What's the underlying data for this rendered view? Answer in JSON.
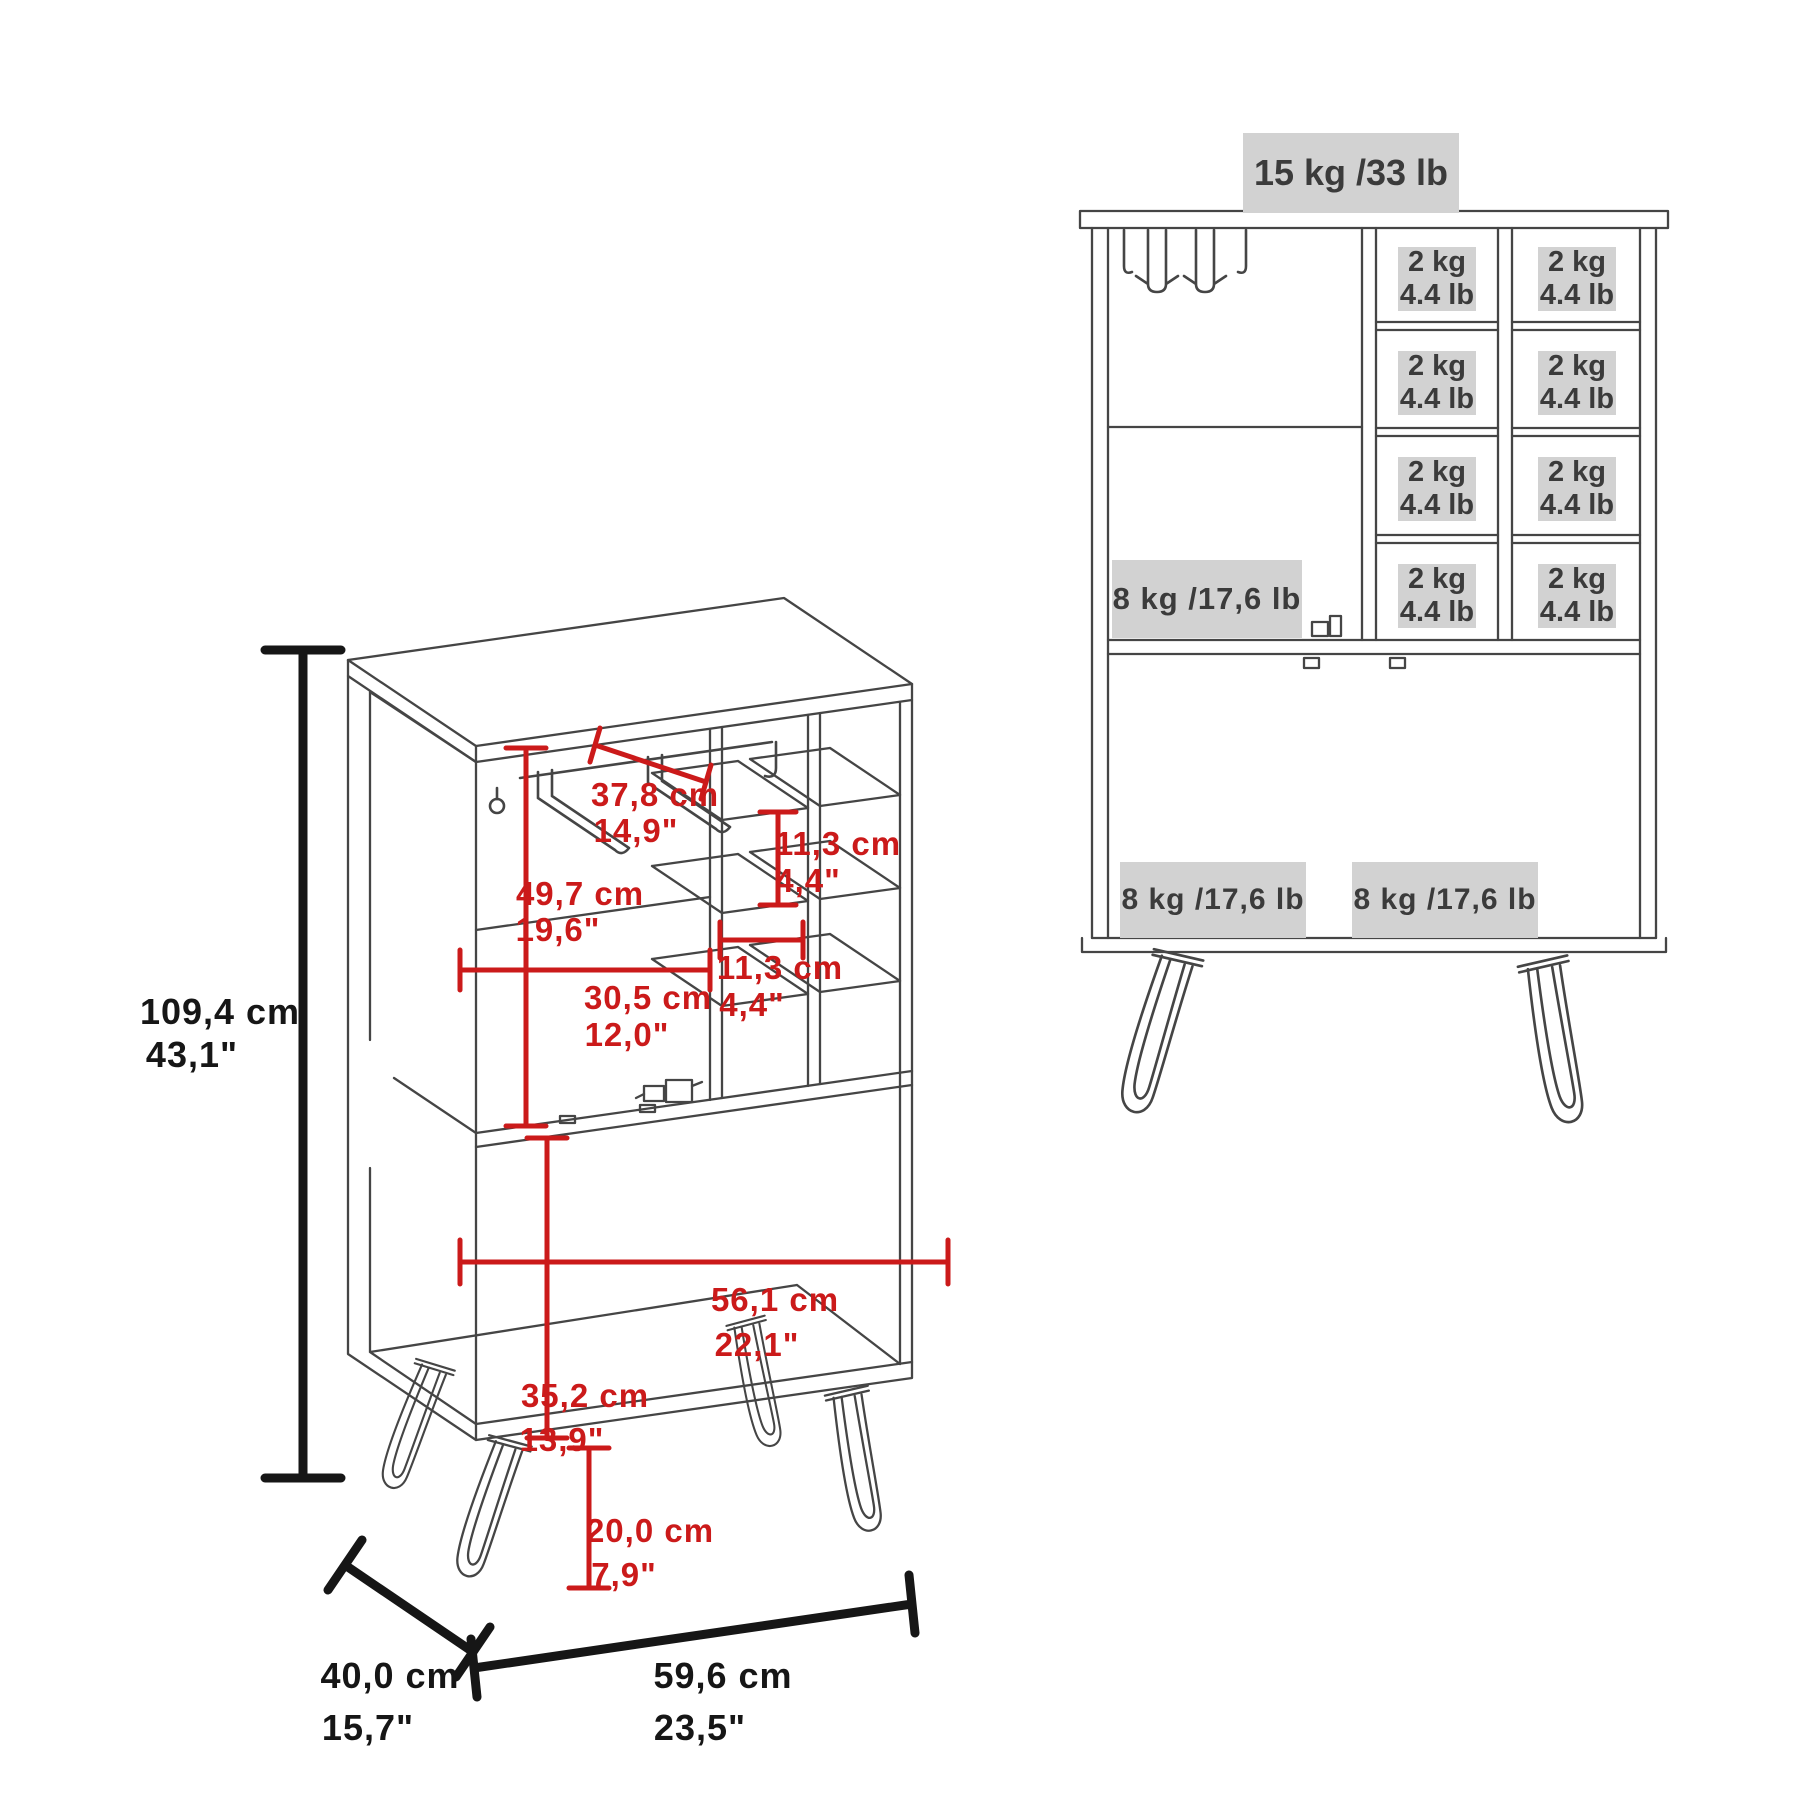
{
  "left": {
    "height": {
      "cm": "109,4 cm",
      "in": "43,1\""
    },
    "rack_width": {
      "cm": "37,8 cm",
      "in": "14,9\""
    },
    "upper_height": {
      "cm": "49,7 cm",
      "in": "19,6\""
    },
    "cubby_height": {
      "cm": "11,3 cm",
      "in": "4,4\""
    },
    "interior_width": {
      "cm": "30,5 cm",
      "in": "12,0\""
    },
    "cubby_width": {
      "cm": "11,3 cm",
      "in": "4,4\""
    },
    "lower_width": {
      "cm": "56,1 cm",
      "in": "22,1\""
    },
    "lower_height": {
      "cm": "35,2 cm",
      "in": "13,9\""
    },
    "leg_height": {
      "cm": "20,0 cm",
      "in": "7,9\""
    },
    "depth": {
      "cm": "40,0 cm",
      "in": "15,7\""
    },
    "width": {
      "cm": "59,6 cm",
      "in": "23,5\""
    }
  },
  "right": {
    "top_capacity": "15 kg /33 lb",
    "shelf_capacity": "8 kg /17,6 lb",
    "cubby_capacity": {
      "kg": "2 kg",
      "lb": "4.4 lb"
    },
    "door_capacity_left": "8 kg /17,6 lb",
    "door_capacity_right": "8 kg /17,6 lb"
  },
  "colors": {
    "dimension_red": "#cb1a1a",
    "dimension_black": "#161616",
    "line_gray": "#454545",
    "badge_bg": "#d2d2d2"
  }
}
